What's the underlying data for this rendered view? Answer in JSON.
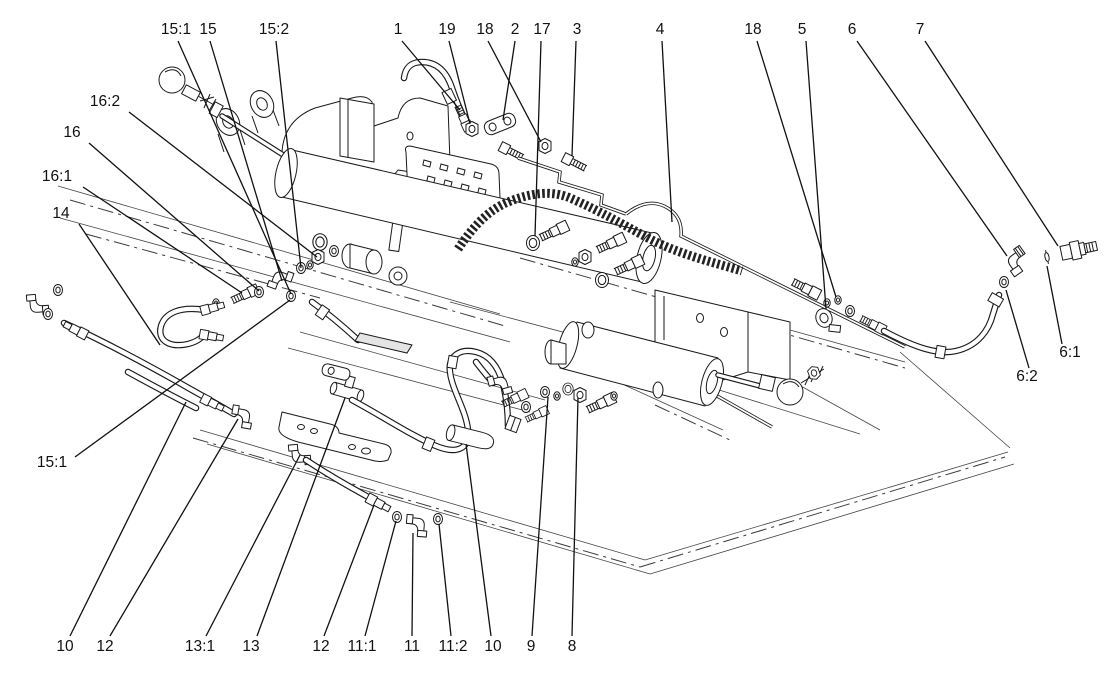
{
  "diagram": {
    "title": "",
    "background": "#ffffff",
    "line_color": "#111111",
    "label_font_size": 15.5,
    "callouts": [
      {
        "label": "15:1",
        "tx": 176,
        "ty": 34,
        "x1": 178,
        "y1": 41,
        "x2": 291,
        "y2": 294
      },
      {
        "label": "15",
        "tx": 208,
        "ty": 34,
        "x1": 210,
        "y1": 41,
        "x2": 282,
        "y2": 281
      },
      {
        "label": "15:2",
        "tx": 274,
        "ty": 34,
        "x1": 276,
        "y1": 41,
        "x2": 301,
        "y2": 268
      },
      {
        "label": "1",
        "tx": 398,
        "ty": 34,
        "x1": 402,
        "y1": 41,
        "x2": 460,
        "y2": 110
      },
      {
        "label": "19",
        "tx": 447,
        "ty": 34,
        "x1": 449,
        "y1": 41,
        "x2": 470,
        "y2": 124
      },
      {
        "label": "18",
        "tx": 485,
        "ty": 34,
        "x1": 488,
        "y1": 41,
        "x2": 541,
        "y2": 142
      },
      {
        "label": "2",
        "tx": 515,
        "ty": 34,
        "x1": 515,
        "y1": 41,
        "x2": 503,
        "y2": 120
      },
      {
        "label": "17",
        "tx": 542,
        "ty": 34,
        "x1": 541,
        "y1": 41,
        "x2": 535,
        "y2": 236
      },
      {
        "label": "3",
        "tx": 577,
        "ty": 34,
        "x1": 576,
        "y1": 41,
        "x2": 572,
        "y2": 156
      },
      {
        "label": "4",
        "tx": 660,
        "ty": 34,
        "x1": 662,
        "y1": 41,
        "x2": 672,
        "y2": 222
      },
      {
        "label": "18",
        "tx": 753,
        "ty": 34,
        "x1": 757,
        "y1": 41,
        "x2": 836,
        "y2": 297
      },
      {
        "label": "5",
        "tx": 802,
        "ty": 34,
        "x1": 806,
        "y1": 41,
        "x2": 826,
        "y2": 309
      },
      {
        "label": "6",
        "tx": 852,
        "ty": 34,
        "x1": 857,
        "y1": 41,
        "x2": 1007,
        "y2": 256
      },
      {
        "label": "7",
        "tx": 920,
        "ty": 34,
        "x1": 925,
        "y1": 41,
        "x2": 1058,
        "y2": 246
      },
      {
        "label": "16:2",
        "tx": 105,
        "ty": 106,
        "x1": 129,
        "y1": 112,
        "x2": 317,
        "y2": 257
      },
      {
        "label": "16",
        "tx": 72,
        "ty": 137,
        "x1": 89,
        "y1": 143,
        "x2": 259,
        "y2": 291
      },
      {
        "label": "16:1",
        "tx": 57,
        "ty": 181,
        "x1": 83,
        "y1": 187,
        "x2": 242,
        "y2": 293
      },
      {
        "label": "14",
        "tx": 61,
        "ty": 218,
        "x1": 79,
        "y1": 224,
        "x2": 160,
        "y2": 345
      },
      {
        "label": "15:1",
        "tx": 52,
        "ty": 467,
        "x1": 75,
        "y1": 457,
        "x2": 290,
        "y2": 300
      },
      {
        "label": "6:1",
        "tx": 1070,
        "ty": 357,
        "x1": 1062,
        "y1": 344,
        "x2": 1047,
        "y2": 266
      },
      {
        "label": "6:2",
        "tx": 1027,
        "ty": 381,
        "x1": 1029,
        "y1": 368,
        "x2": 1006,
        "y2": 290
      },
      {
        "label": "10",
        "tx": 65,
        "ty": 651,
        "x1": 70,
        "y1": 636,
        "x2": 186,
        "y2": 402
      },
      {
        "label": "12",
        "tx": 105,
        "ty": 651,
        "x1": 110,
        "y1": 636,
        "x2": 238,
        "y2": 419
      },
      {
        "label": "13:1",
        "tx": 200,
        "ty": 651,
        "x1": 206,
        "y1": 636,
        "x2": 300,
        "y2": 455
      },
      {
        "label": "13",
        "tx": 251,
        "ty": 651,
        "x1": 257,
        "y1": 636,
        "x2": 345,
        "y2": 398
      },
      {
        "label": "12",
        "tx": 321,
        "ty": 651,
        "x1": 324,
        "y1": 636,
        "x2": 374,
        "y2": 505
      },
      {
        "label": "11:1",
        "tx": 362,
        "ty": 651,
        "x1": 365,
        "y1": 636,
        "x2": 396,
        "y2": 521
      },
      {
        "label": "11",
        "tx": 412,
        "ty": 651,
        "x1": 412,
        "y1": 636,
        "x2": 413,
        "y2": 533
      },
      {
        "label": "11:2",
        "tx": 453,
        "ty": 651,
        "x1": 451,
        "y1": 636,
        "x2": 439,
        "y2": 524
      },
      {
        "label": "10",
        "tx": 493,
        "ty": 651,
        "x1": 491,
        "y1": 636,
        "x2": 466,
        "y2": 444
      },
      {
        "label": "9",
        "tx": 531,
        "ty": 651,
        "x1": 532,
        "y1": 636,
        "x2": 548,
        "y2": 397
      },
      {
        "label": "8",
        "tx": 572,
        "ty": 651,
        "x1": 572,
        "y1": 636,
        "x2": 578,
        "y2": 398
      }
    ]
  }
}
